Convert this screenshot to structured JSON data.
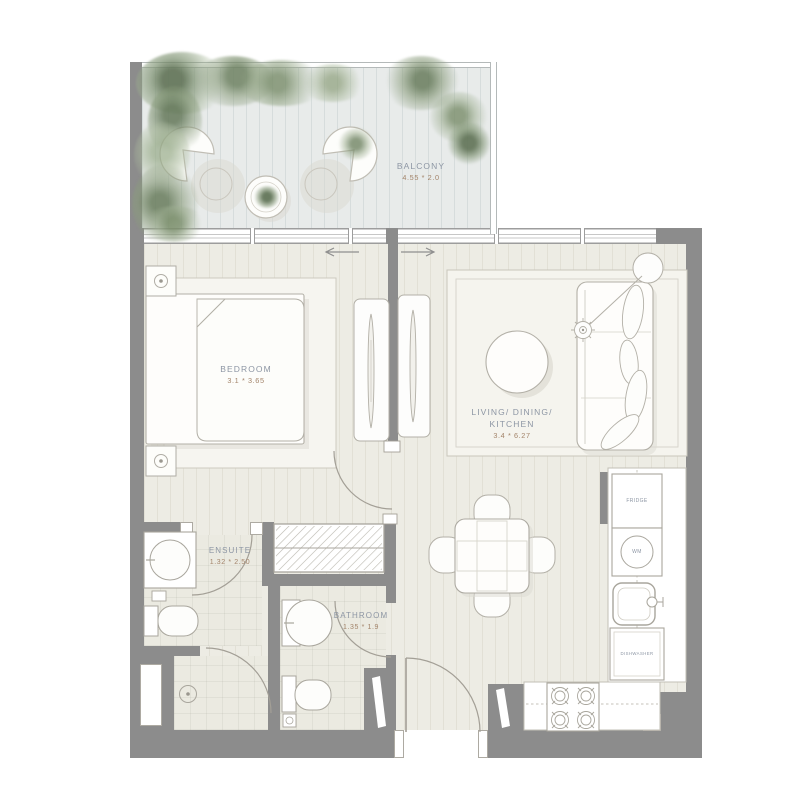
{
  "rooms": {
    "balcony": {
      "name": "BALCONY",
      "dims": "4.55 * 2.0"
    },
    "bedroom": {
      "name": "BEDROOM",
      "dims": "3.1 * 3.65"
    },
    "living": {
      "line1": "LIVING/ DINING/",
      "line2": "KITCHEN",
      "dims": "3.4 * 6.27"
    },
    "ensuite": {
      "name": "ENSUITE",
      "dims": "1.32 * 2.50"
    },
    "bathroom": {
      "name": "BATHROOM",
      "dims": "1.35 * 1.9"
    }
  },
  "kitchen": {
    "fridge": "FRIDGE",
    "washing_machine": "WM",
    "dishwasher": "DISHWASHER"
  },
  "colors": {
    "wall": "#8c8c8c",
    "interior_floor": "#edece4",
    "balcony_floor": "#e8ebea",
    "room_label": "#8d96a4",
    "dim_label": "#a3846a",
    "furniture_outline": "#b3b0a7",
    "greenery": "#7f9472"
  }
}
